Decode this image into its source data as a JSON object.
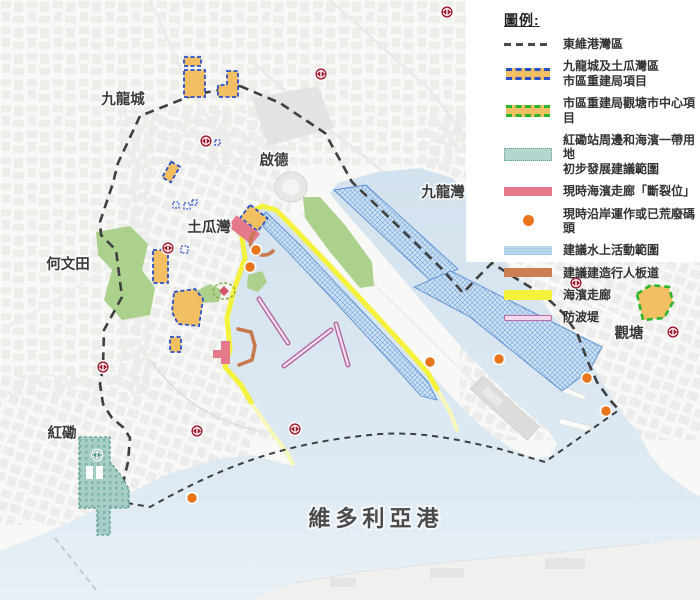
{
  "legend": {
    "title": "圖例:",
    "items": [
      {
        "type": "boundary-dash",
        "lines": [
          "東維港灣區"
        ]
      },
      {
        "type": "ura-blue",
        "lines": [
          "九龍城及土瓜灣區",
          "市區重建局項目"
        ]
      },
      {
        "type": "ura-green",
        "lines": [
          "市區重建局觀塘市中心項目"
        ]
      },
      {
        "type": "teal-zone",
        "lines": [
          "紅磡站周邊和海濱一帶用地",
          "初步發展建議範圍"
        ]
      },
      {
        "type": "pink-bar",
        "lines": [
          "現時海濱走廊「斷裂位」"
        ]
      },
      {
        "type": "orange-dot",
        "lines": [
          "現時沿岸運作或已荒廢碼頭"
        ]
      },
      {
        "type": "blue-bar",
        "lines": [
          "建議水上活動範圍"
        ]
      },
      {
        "type": "brown-bar",
        "lines": [
          "建議建造行人板道"
        ]
      },
      {
        "type": "yellow-bar",
        "lines": [
          "海濱走廊"
        ]
      },
      {
        "type": "pink-line",
        "lines": [
          "防波堤"
        ]
      }
    ]
  },
  "map": {
    "district_labels": [
      {
        "text": "九龍城",
        "x": 123,
        "y": 104
      },
      {
        "text": "啟德",
        "x": 274,
        "y": 165
      },
      {
        "text": "九龍灣",
        "x": 443,
        "y": 197
      },
      {
        "text": "土瓜灣",
        "x": 209,
        "y": 232
      },
      {
        "text": "何文田",
        "x": 68,
        "y": 269
      },
      {
        "text": "觀塘",
        "x": 629,
        "y": 338
      },
      {
        "text": "紅磡",
        "x": 62,
        "y": 438
      }
    ],
    "harbour_label": {
      "text": "維多利亞港",
      "x": 376,
      "y": 526
    },
    "mtr_stations": [
      [
        321,
        74
      ],
      [
        447,
        12
      ],
      [
        206,
        141
      ],
      [
        168,
        248
      ],
      [
        103,
        367
      ],
      [
        197,
        431
      ],
      [
        295,
        429
      ],
      [
        576,
        283
      ],
      [
        673,
        332
      ]
    ],
    "mtr_station_teal": [
      97,
      455
    ],
    "pier_dots": [
      [
        256,
        250
      ],
      [
        250,
        267
      ],
      [
        430,
        362
      ],
      [
        499,
        359
      ],
      [
        587,
        378
      ],
      [
        606,
        411
      ],
      [
        192,
        498
      ]
    ]
  },
  "colors": {
    "boundary": "#3f3f3f",
    "ura_fill": "#f2c063",
    "ura_blue_border": "#2b50c8",
    "ura_green_border": "#2eb52e",
    "teal_zone": "#a6cdc6",
    "pink_break": "#e4798a",
    "pier_dot": "#e8751c",
    "water_activity": "#bcd6ee",
    "boardwalk": "#c8794e",
    "promenade_yellow": "#f5f23d",
    "breakwater": "#bd68a8",
    "mtr_red": "#9e1f32",
    "park_green": "#abd18d",
    "water": "#d8e6f0"
  }
}
